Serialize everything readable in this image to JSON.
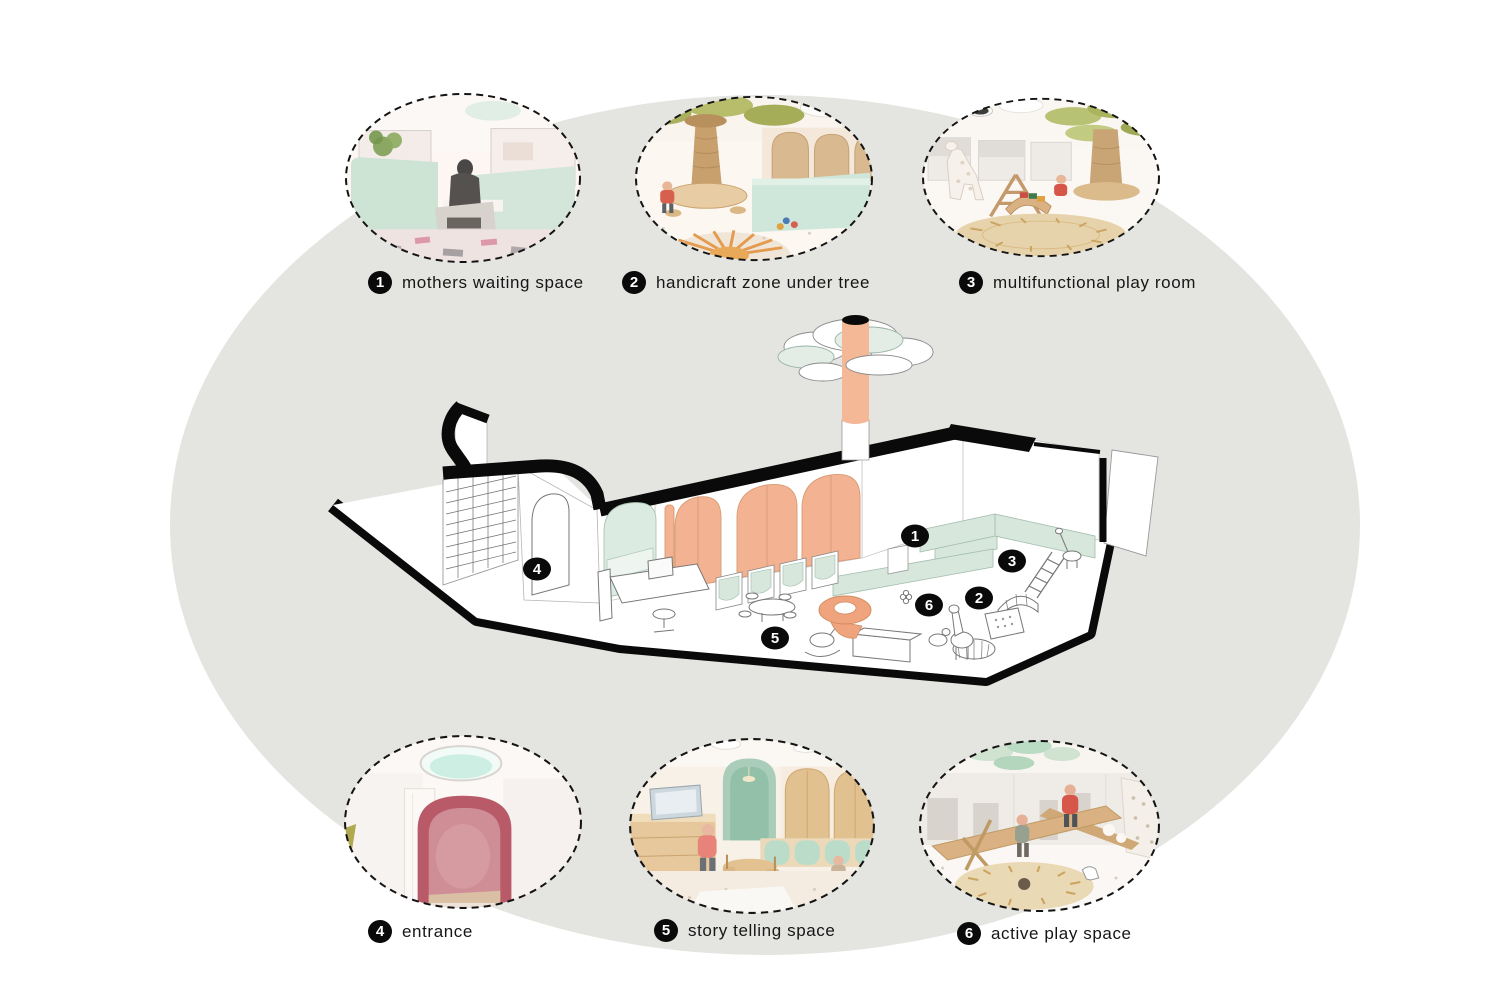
{
  "palette": {
    "page_background": "#ffffff",
    "ellipse_background": "#e4e4e1",
    "peach": "#f3b291",
    "peach_dark": "#efa47d",
    "mint": "#d7e7dc",
    "mint_light": "#e6f0ea",
    "olive_green": "#b3bd6d",
    "entrance_pink": "#b85a68",
    "wood_tan": "#d9b183",
    "line_black": "#0a0a0a"
  },
  "legend": {
    "items": [
      {
        "number": "1",
        "label": "mothers waiting space"
      },
      {
        "number": "2",
        "label": "handicraft zone under tree"
      },
      {
        "number": "3",
        "label": "multifunctional play room"
      },
      {
        "number": "4",
        "label": "entrance"
      },
      {
        "number": "5",
        "label": "story telling space"
      },
      {
        "number": "6",
        "label": "active play space"
      }
    ]
  },
  "plan": {
    "markers": [
      {
        "number": "1",
        "space": "mothers waiting space"
      },
      {
        "number": "2",
        "space": "handicraft zone under tree"
      },
      {
        "number": "3",
        "space": "multifunctional play room"
      },
      {
        "number": "4",
        "space": "entrance"
      },
      {
        "number": "5",
        "space": "story telling space"
      },
      {
        "number": "6",
        "space": "active play space"
      }
    ]
  }
}
